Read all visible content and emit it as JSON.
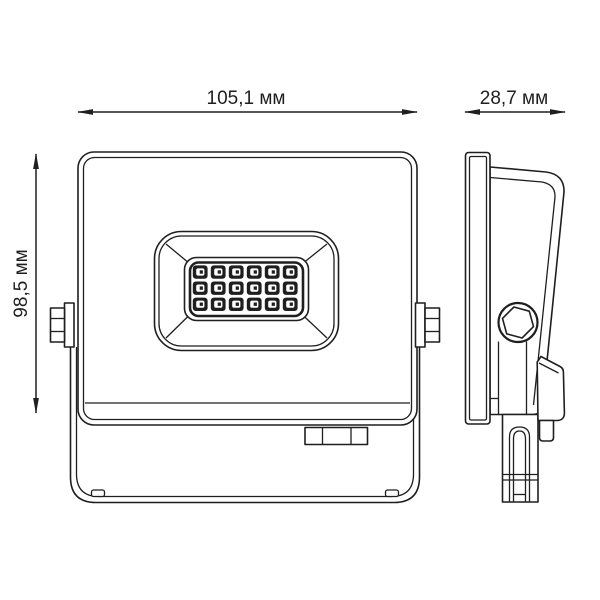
{
  "title": "LED floodlight dimensional drawing",
  "units": "мм",
  "dimensions": {
    "width": {
      "value": "105,1",
      "unit": "мм",
      "label": "105,1 мм"
    },
    "depth": {
      "value": "28,7",
      "unit": "мм",
      "label": "28,7 мм"
    },
    "height": {
      "value": "98,5",
      "unit": "мм",
      "label": "98,5 мм"
    }
  },
  "front_view": {
    "name": "front-view",
    "led_grid": {
      "rows": 3,
      "columns": 6,
      "count": 18
    }
  },
  "side_view": {
    "name": "side-view"
  },
  "colors": {
    "line": "#1f1f1f",
    "background": "#ffffff",
    "led": "#1f1f1f"
  }
}
